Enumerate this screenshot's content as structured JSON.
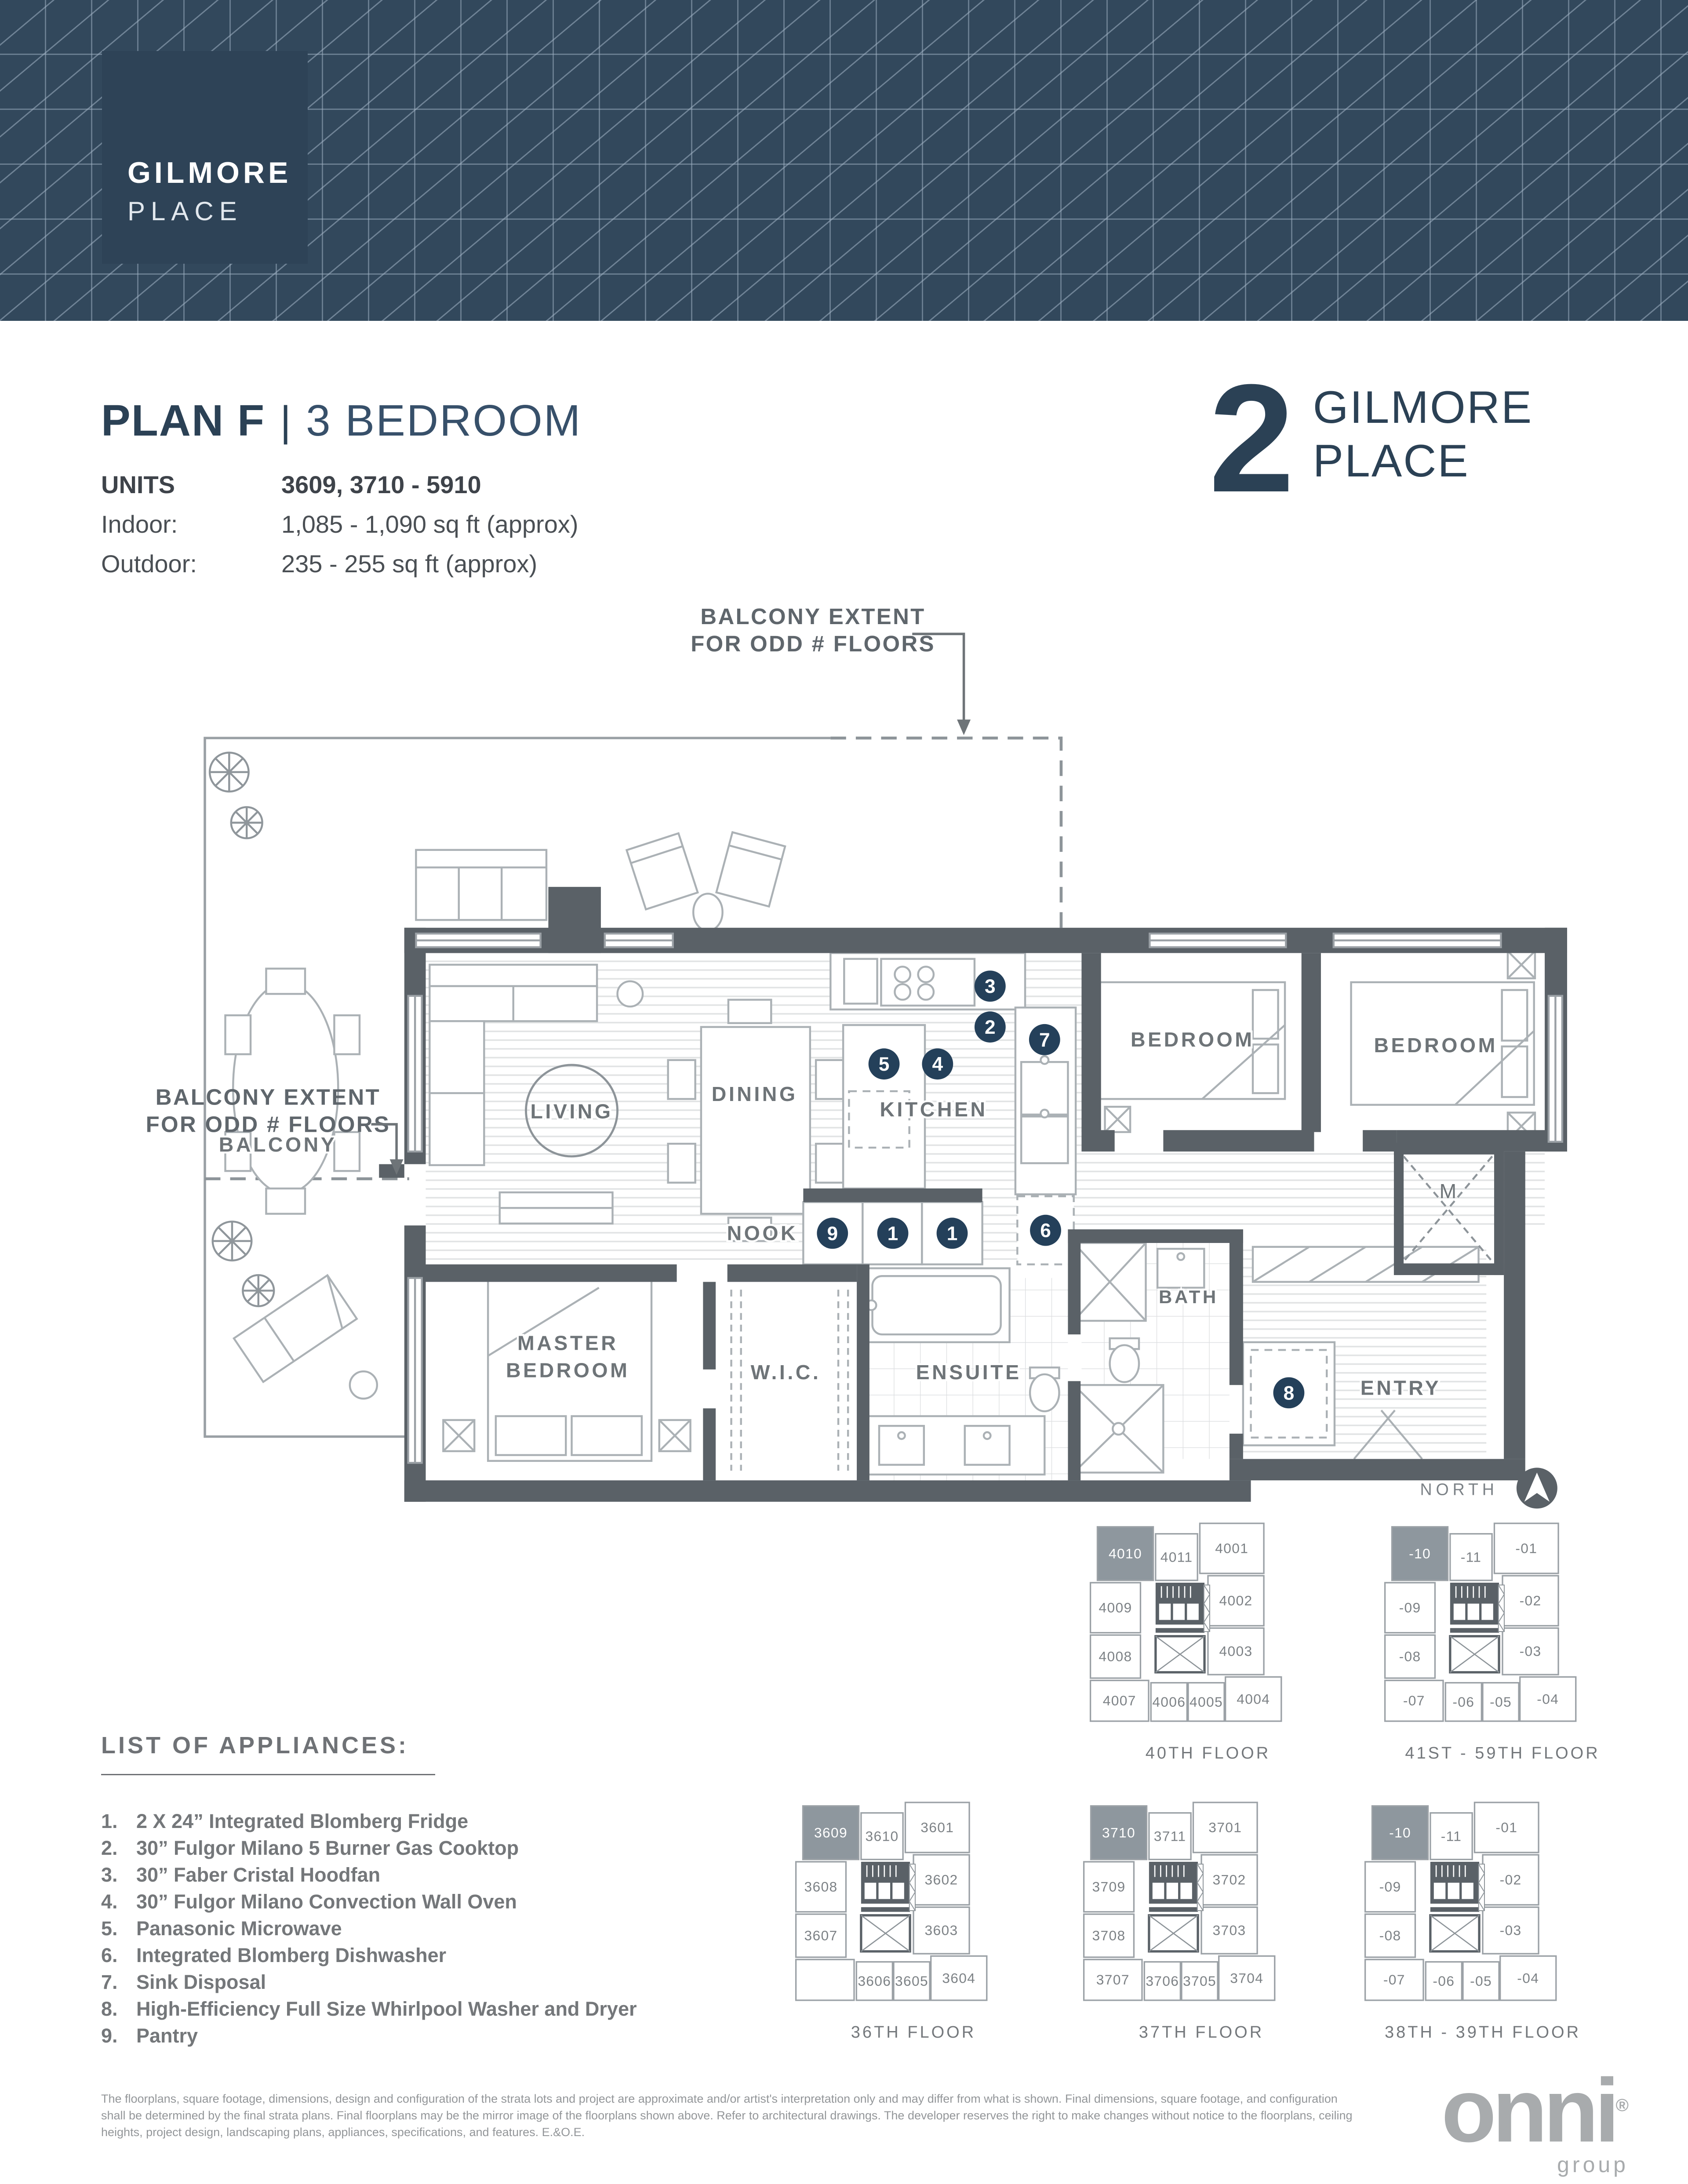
{
  "colors": {
    "header_bg": "#32485c",
    "header_line": "#a0b2c4",
    "logo_box": "#2e4357",
    "navy": "#2b4155",
    "marker": "#24405a",
    "wall": "#5a6167",
    "furniture_line": "#abb1b5",
    "label_gray": "#6e7478",
    "keyplan_highlight": "#8e979e",
    "footer_gray": "#939699"
  },
  "header": {
    "logo_line1": "GILMORE",
    "logo_line2": "PLACE"
  },
  "title": {
    "plan": "PLAN F",
    "sep": "|",
    "type": "3 BEDROOM",
    "units_label": "UNITS",
    "units_value": "3609, 3710 - 5910",
    "indoor_label": "Indoor:",
    "indoor_value": "1,085 - 1,090 sq ft (approx)",
    "outdoor_label": "Outdoor:",
    "outdoor_value": "235 - 255 sq ft (approx)"
  },
  "brand": {
    "number": "2",
    "line1": "GILMORE",
    "line2": "PLACE"
  },
  "plan": {
    "note": {
      "line1": "BALCONY EXTENT",
      "line2": "FOR ODD # FLOORS"
    },
    "rooms": {
      "balcony": "BALCONY",
      "living": "LIVING",
      "dining": "DINING",
      "kitchen": "KITCHEN",
      "bedroom_a": "BEDROOM",
      "bedroom_b": "BEDROOM",
      "nook": "NOOK",
      "master1": "MASTER",
      "master2": "BEDROOM",
      "wic": "W.I.C.",
      "ensuite": "ENSUITE",
      "bath": "BATH",
      "entry": "ENTRY",
      "m_closet": "M"
    },
    "north_label": "NORTH",
    "markers": [
      {
        "id": "hoodfan",
        "label": "3"
      },
      {
        "id": "cooktop",
        "label": "2"
      },
      {
        "id": "oven",
        "label": "4"
      },
      {
        "id": "disposal",
        "label": "7"
      },
      {
        "id": "microwave",
        "label": "5"
      },
      {
        "id": "dishwasher",
        "label": "6"
      },
      {
        "id": "pantry",
        "label": "9"
      },
      {
        "id": "fridge_a",
        "label": "1"
      },
      {
        "id": "fridge_b",
        "label": "1"
      },
      {
        "id": "laundry",
        "label": "8"
      }
    ]
  },
  "appliances": {
    "heading": "LIST OF APPLIANCES:",
    "items": [
      {
        "num": "1.",
        "text": "2 X 24” Integrated Blomberg Fridge"
      },
      {
        "num": "2.",
        "text": "30” Fulgor Milano 5 Burner Gas Cooktop"
      },
      {
        "num": "3.",
        "text": "30” Faber Cristal Hoodfan"
      },
      {
        "num": "4.",
        "text": "30” Fulgor Milano Convection Wall Oven"
      },
      {
        "num": "5.",
        "text": "Panasonic Microwave"
      },
      {
        "num": "6.",
        "text": "Integrated Blomberg Dishwasher"
      },
      {
        "num": "7.",
        "text": "Sink Disposal"
      },
      {
        "num": "8.",
        "text": "High-Efficiency Full Size Whirlpool Washer and Dryer"
      },
      {
        "num": "9.",
        "text": "Pantry"
      }
    ]
  },
  "keyplans": [
    {
      "title": "40TH FLOOR",
      "cells": [
        {
          "label": "4010",
          "hl": true
        },
        {
          "label": "4011",
          "hl": false
        },
        {
          "label": "4001",
          "hl": false
        },
        {
          "label": "4009",
          "hl": false
        },
        {
          "label": "4002",
          "hl": false
        },
        {
          "label": "4008",
          "hl": false
        },
        {
          "label": "4003",
          "hl": false
        },
        {
          "label": "4007",
          "hl": false
        },
        {
          "label": "4006",
          "hl": false
        },
        {
          "label": "4005",
          "hl": false
        },
        {
          "label": "4004",
          "hl": false
        }
      ]
    },
    {
      "title": "41ST - 59TH FLOOR",
      "cells": [
        {
          "label": "-10",
          "hl": true
        },
        {
          "label": "-11",
          "hl": false
        },
        {
          "label": "-01",
          "hl": false
        },
        {
          "label": "-09",
          "hl": false
        },
        {
          "label": "-02",
          "hl": false
        },
        {
          "label": "-08",
          "hl": false
        },
        {
          "label": "-03",
          "hl": false
        },
        {
          "label": "-07",
          "hl": false
        },
        {
          "label": "-06",
          "hl": false
        },
        {
          "label": "-05",
          "hl": false
        },
        {
          "label": "-04",
          "hl": false
        }
      ]
    },
    {
      "title": "36TH FLOOR",
      "cells": [
        {
          "label": "3609",
          "hl": true
        },
        {
          "label": "3610",
          "hl": false
        },
        {
          "label": "3601",
          "hl": false
        },
        {
          "label": "3608",
          "hl": false
        },
        {
          "label": "3602",
          "hl": false
        },
        {
          "label": "3607",
          "hl": false
        },
        {
          "label": "3603",
          "hl": false
        },
        {
          "label": "",
          "hl": false
        },
        {
          "label": "3606",
          "hl": false
        },
        {
          "label": "3605",
          "hl": false
        },
        {
          "label": "3604",
          "hl": false
        }
      ]
    },
    {
      "title": "37TH FLOOR",
      "cells": [
        {
          "label": "3710",
          "hl": true
        },
        {
          "label": "3711",
          "hl": false
        },
        {
          "label": "3701",
          "hl": false
        },
        {
          "label": "3709",
          "hl": false
        },
        {
          "label": "3702",
          "hl": false
        },
        {
          "label": "3708",
          "hl": false
        },
        {
          "label": "3703",
          "hl": false
        },
        {
          "label": "3707",
          "hl": false
        },
        {
          "label": "3706",
          "hl": false
        },
        {
          "label": "3705",
          "hl": false
        },
        {
          "label": "3704",
          "hl": false
        }
      ]
    },
    {
      "title": "38TH - 39TH FLOOR",
      "cells": [
        {
          "label": "-10",
          "hl": true
        },
        {
          "label": "-11",
          "hl": false
        },
        {
          "label": "-01",
          "hl": false
        },
        {
          "label": "-09",
          "hl": false
        },
        {
          "label": "-02",
          "hl": false
        },
        {
          "label": "-08",
          "hl": false
        },
        {
          "label": "-03",
          "hl": false
        },
        {
          "label": "-07",
          "hl": false
        },
        {
          "label": "-06",
          "hl": false
        },
        {
          "label": "-05",
          "hl": false
        },
        {
          "label": "-04",
          "hl": false
        }
      ]
    }
  ],
  "footer": {
    "disclaimer": "The floorplans, square footage, dimensions, design and configuration of the strata lots and project are approximate and/or artist's interpretation only and may differ from what is shown. Final dimensions, square footage, and configuration shall be determined by the final strata plans. Final floorplans may be the mirror image of the floorplans shown above. Refer to architectural drawings. The developer reserves the right to make changes without notice to the floorplans, ceiling heights, project design, landscaping plans, appliances, specifications, and features. E.&O.E.",
    "logo_text": "onni",
    "logo_reg": "®",
    "logo_sub": "group"
  }
}
